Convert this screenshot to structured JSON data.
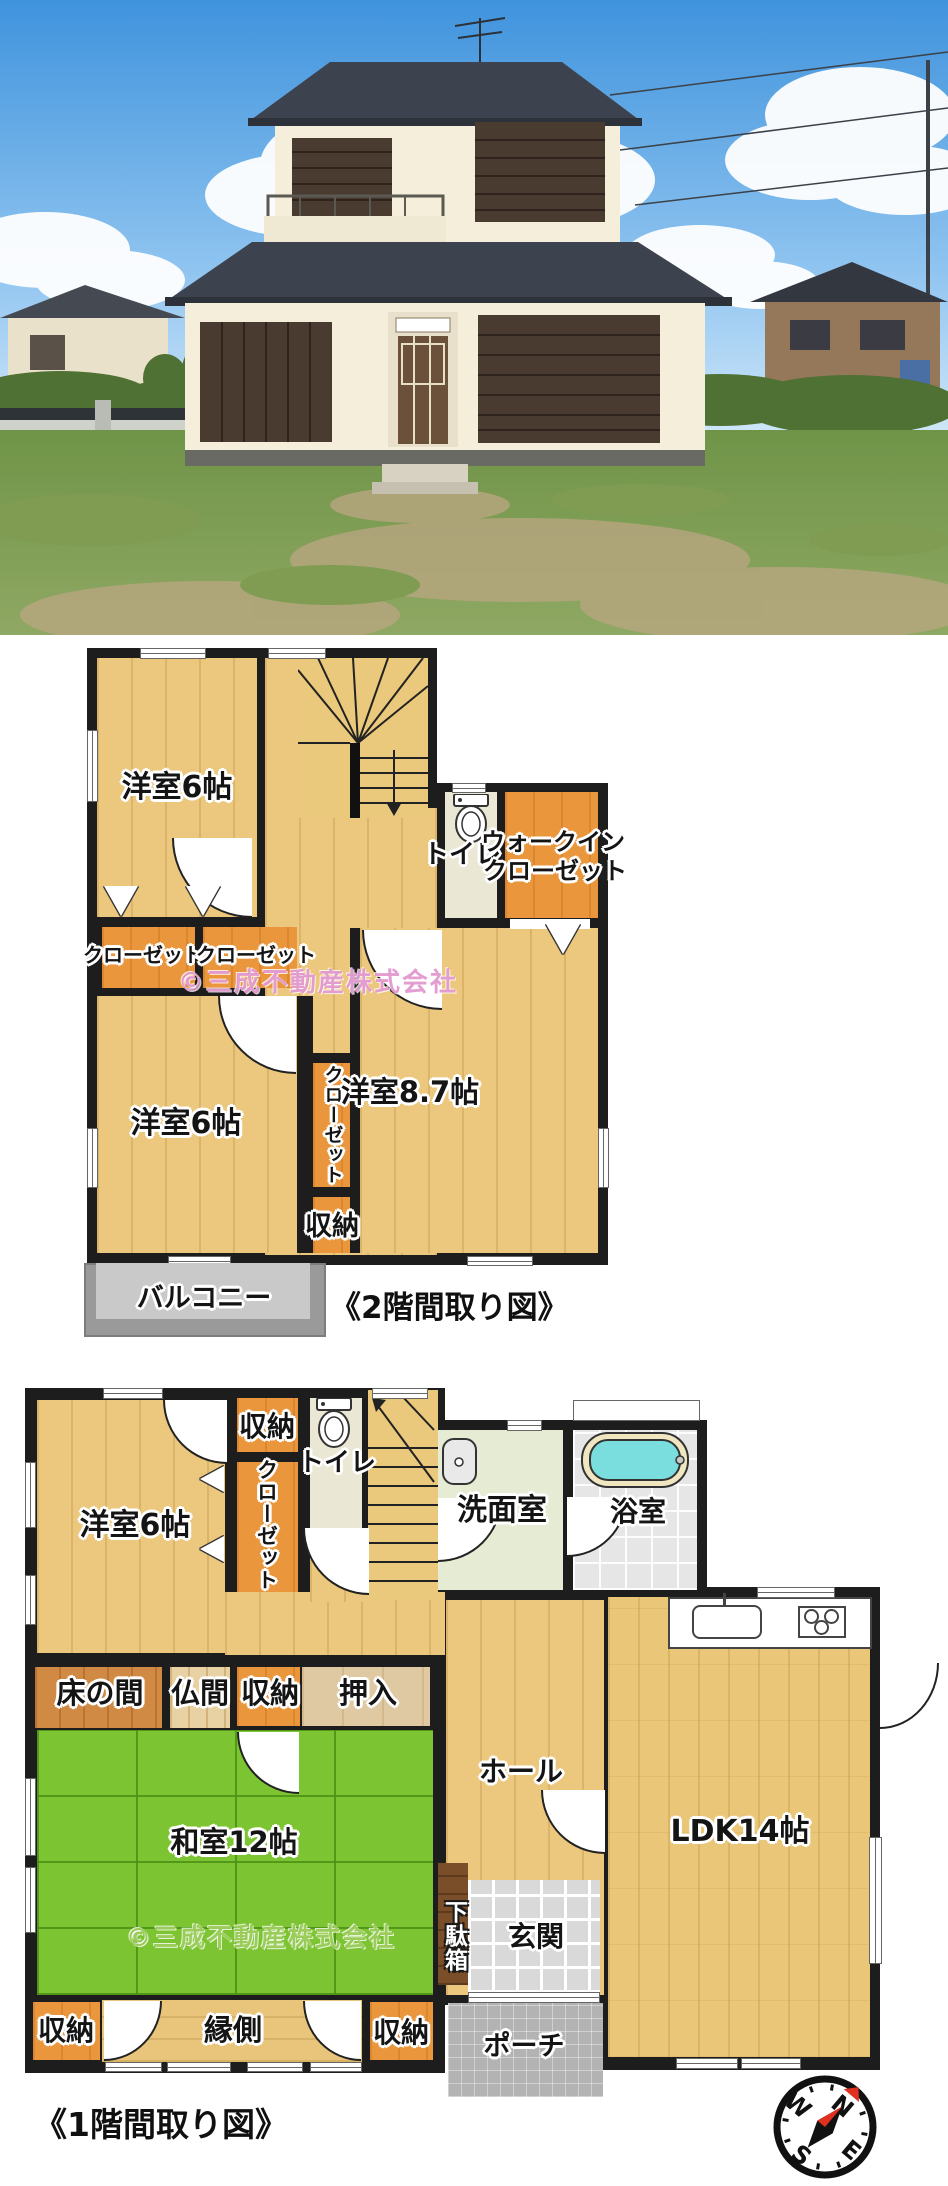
{
  "colors": {
    "wall": "#1d1d1d",
    "wood_floor": "#ecc87e",
    "orange_closet": "#ea963d",
    "tatami_green": "#7dc433",
    "genkan_tile_grey": "#d9d9d9",
    "bathtub_cyan": "#7adede",
    "balcony_grey": "#c6c6c6",
    "watermark_pink": "#de8cc8",
    "watermark_green": "#91c84b",
    "sky_blue": "#4f9ce0",
    "roof_grey": "#3d434e",
    "house_wall_cream": "#f4eeda",
    "shutter_brown": "#4a3b31",
    "compass_red": "#e03020"
  },
  "floor2": {
    "title": "《2階間取り図》",
    "watermark": "©三成不動産株式会社",
    "rooms": {
      "bedroom_top": "洋室6帖",
      "toilet": "トイレ",
      "wic_line1": "ウォークイン",
      "wic_line2": "クローゼット",
      "closet_left": "クローゼット",
      "closet_right": "クローゼット",
      "bedroom_bottom": "洋室6帖",
      "closet_center": "クローゼット",
      "storage": "収納",
      "bedroom_large": "洋室8.7帖",
      "balcony": "バルコニー"
    }
  },
  "floor1": {
    "title": "《1階間取り図》",
    "watermark": "©三成不動産株式会社",
    "rooms": {
      "bedroom": "洋室6帖",
      "storage_top": "収納",
      "closet": "クローゼット",
      "toilet": "トイレ",
      "washroom": "洗面室",
      "bathroom": "浴室",
      "tokonoma": "床の間",
      "butsuma": "仏間",
      "storage_mid": "収納",
      "oshiire": "押入",
      "hall": "ホール",
      "washitsu": "和室12帖",
      "ldk": "LDK14帖",
      "getabako": "下駄箱",
      "genkan": "玄関",
      "storage_bottom_left": "収納",
      "engawa": "縁側",
      "storage_bottom_right": "収納",
      "porch": "ポーチ"
    }
  },
  "compass": {
    "n": "N",
    "e": "E",
    "s": "S",
    "w": "W"
  }
}
